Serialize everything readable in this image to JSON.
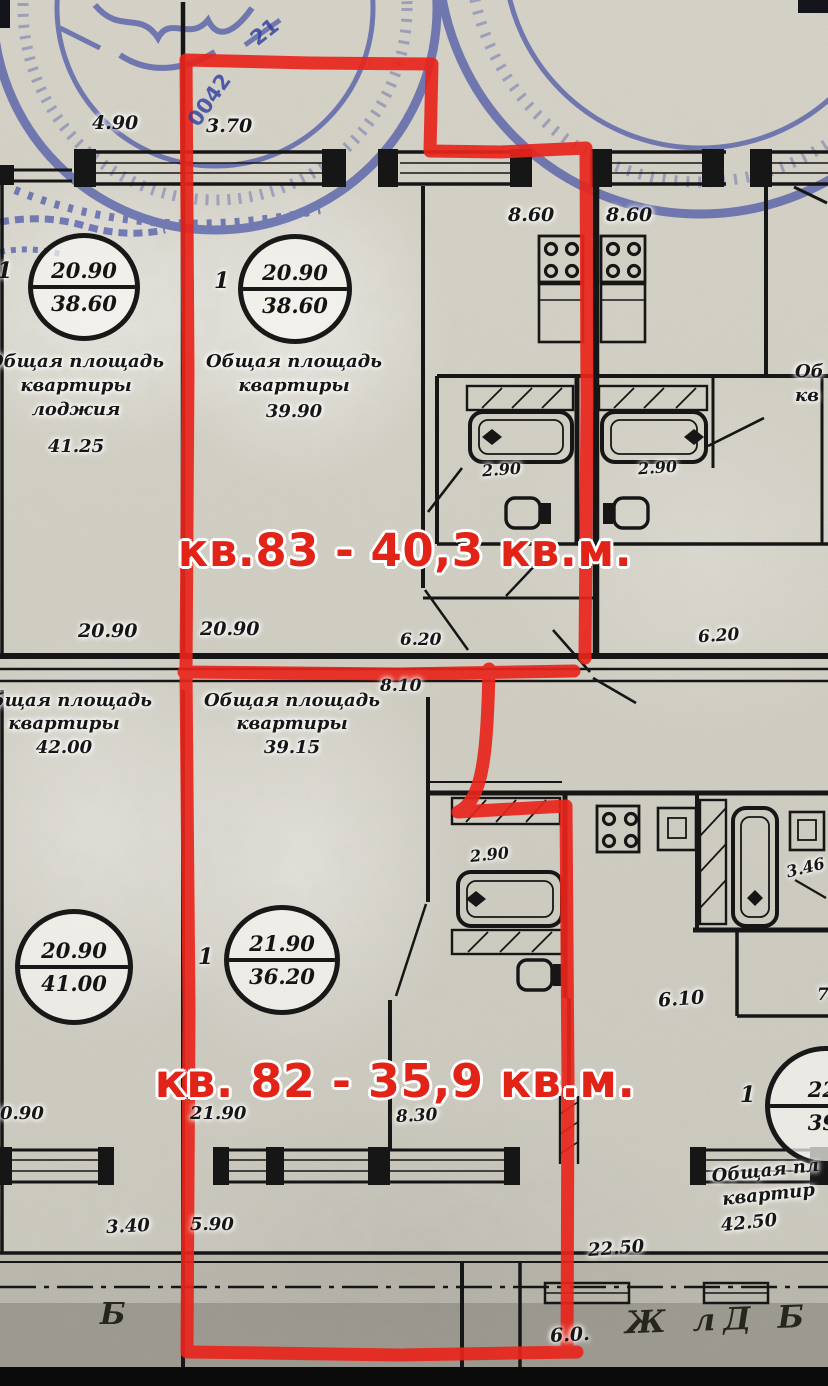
{
  "colors": {
    "annotation_red": "#E8251B",
    "stamp_blue": "#2E3DA0",
    "ink_black": "#161616"
  },
  "red": {
    "apt83_label": "кв.83 - 40,3 кв.м.",
    "apt82_label": "кв. 82 - 35,9 кв.м."
  },
  "stamp": {
    "fragment_number": "0042",
    "fragment_top": "21"
  },
  "dims": {
    "d490": "4.90",
    "d370": "3.70",
    "d860a": "8.60",
    "d860b": "8.60",
    "d290a": "2.90",
    "d290b": "2.90",
    "d2090a": "20.90",
    "d2090b": "20.90",
    "d620a": "6.20",
    "d620b": "6.20",
    "d810": "8.10",
    "d290c": "2.90",
    "d346": "3.46",
    "d610": "6.10",
    "d7": "7",
    "d090": "0.90",
    "d2190": "21.90",
    "d830": "8.30",
    "d340": "3.40",
    "d590": "5.90",
    "d2250": "22.50",
    "d60": "6.0."
  },
  "circles": {
    "c1": {
      "num": "20.90",
      "area": "38.60",
      "prefix": "1"
    },
    "c2": {
      "num": "20.90",
      "area": "38.60",
      "prefix": "1"
    },
    "c3": {
      "num": "20.90",
      "area": "41.00"
    },
    "c4": {
      "num": "21.90",
      "area": "36.20",
      "prefix": "1"
    },
    "c5": {
      "num": "22.",
      "area": "39.",
      "prefix": "1"
    }
  },
  "blocks": {
    "top_left": {
      "l1": "Общая площадь",
      "l2": "квартиры",
      "l3": "лоджия",
      "value": "41.25"
    },
    "top_center": {
      "l1": "Общая площадь",
      "l2": "квартиры",
      "value": "39.90"
    },
    "mid_left": {
      "l1": "Общая площадь",
      "l2": "квартиры",
      "value": "42.00"
    },
    "mid_center": {
      "l1": "Общая площадь",
      "l2": "квартиры",
      "value": "39.15"
    },
    "right_clip": {
      "l1": "Об",
      "l2": "кв"
    },
    "bottom_right": {
      "l1": "Общая пл",
      "l2": "квартир",
      "value": "42.50"
    }
  },
  "axis": {
    "b_marker": "Б",
    "handwritten": "Ж лД Б"
  }
}
